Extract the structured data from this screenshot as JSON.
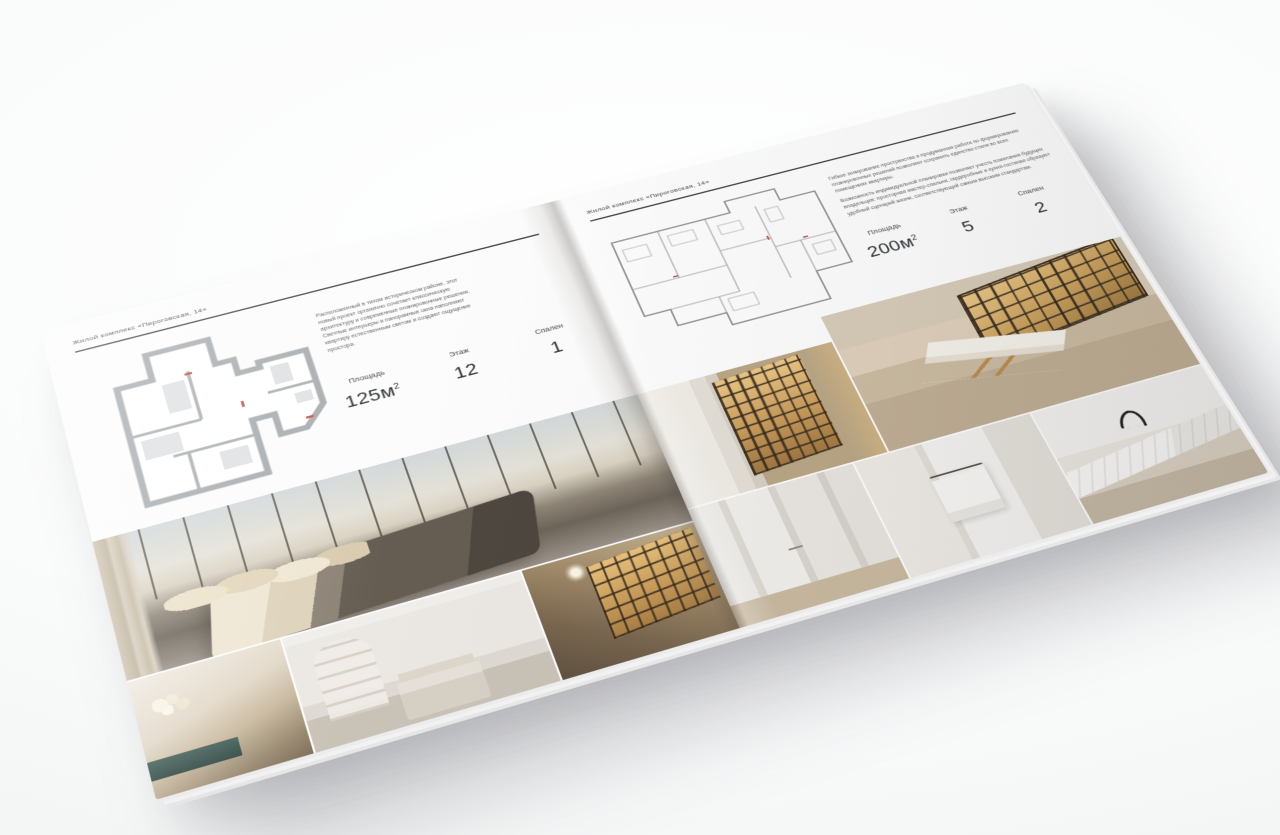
{
  "scene": {
    "backdrop_color": "#f4f6f6",
    "object": "Открытый квадратный буклет-каталог интерьеров, повернут на светлом фоне"
  },
  "brochure": {
    "left_page": {
      "header": "Жилой комплекс «Пироговская, 14»",
      "description": "Расположенный в тихом историческом районе, этот новый проект органично сочетает классическую архитектуру и современные планировочные решения. Светлые интерьеры и панорамные окна наполняют квартиру естественным светом и создают ощущение простора.",
      "specs": [
        {
          "label": "Площадь",
          "value": "125м",
          "sup": "2"
        },
        {
          "label": "Этаж",
          "value": "12"
        },
        {
          "label": "Спален",
          "value": "1"
        }
      ],
      "floor_plan": "floor-plan-125",
      "photos": [
        "bedroom-panorama",
        "bedside-detail",
        "white-bedroom",
        "hallway-bookcase"
      ]
    },
    "right_page": {
      "header": "Жилой комплекс «Пироговская, 14»",
      "description_1": "Гибкое зонирование пространства и продуманная работа по формированию планировочных решений позволяют сохранить единство стиля во всех помещениях квартиры.",
      "description_2": "Возможность индивидуальной планировки позволяет учесть пожелания будущих владельцев: просторная мастер-спальня, гардеробные и кухня-гостиная образуют удобный сценарий жизни, соответствующий самым высоким стандартам.",
      "specs": [
        {
          "label": "Площадь",
          "value": "200м",
          "sup": "2"
        },
        {
          "label": "Этаж",
          "value": "5"
        },
        {
          "label": "Спален",
          "value": "2"
        }
      ],
      "floor_plan": "floor-plan-200",
      "photos": [
        "wardrobe-cabinets",
        "study-desk",
        "corridor",
        "bathroom",
        "kitchen-counter"
      ]
    }
  }
}
